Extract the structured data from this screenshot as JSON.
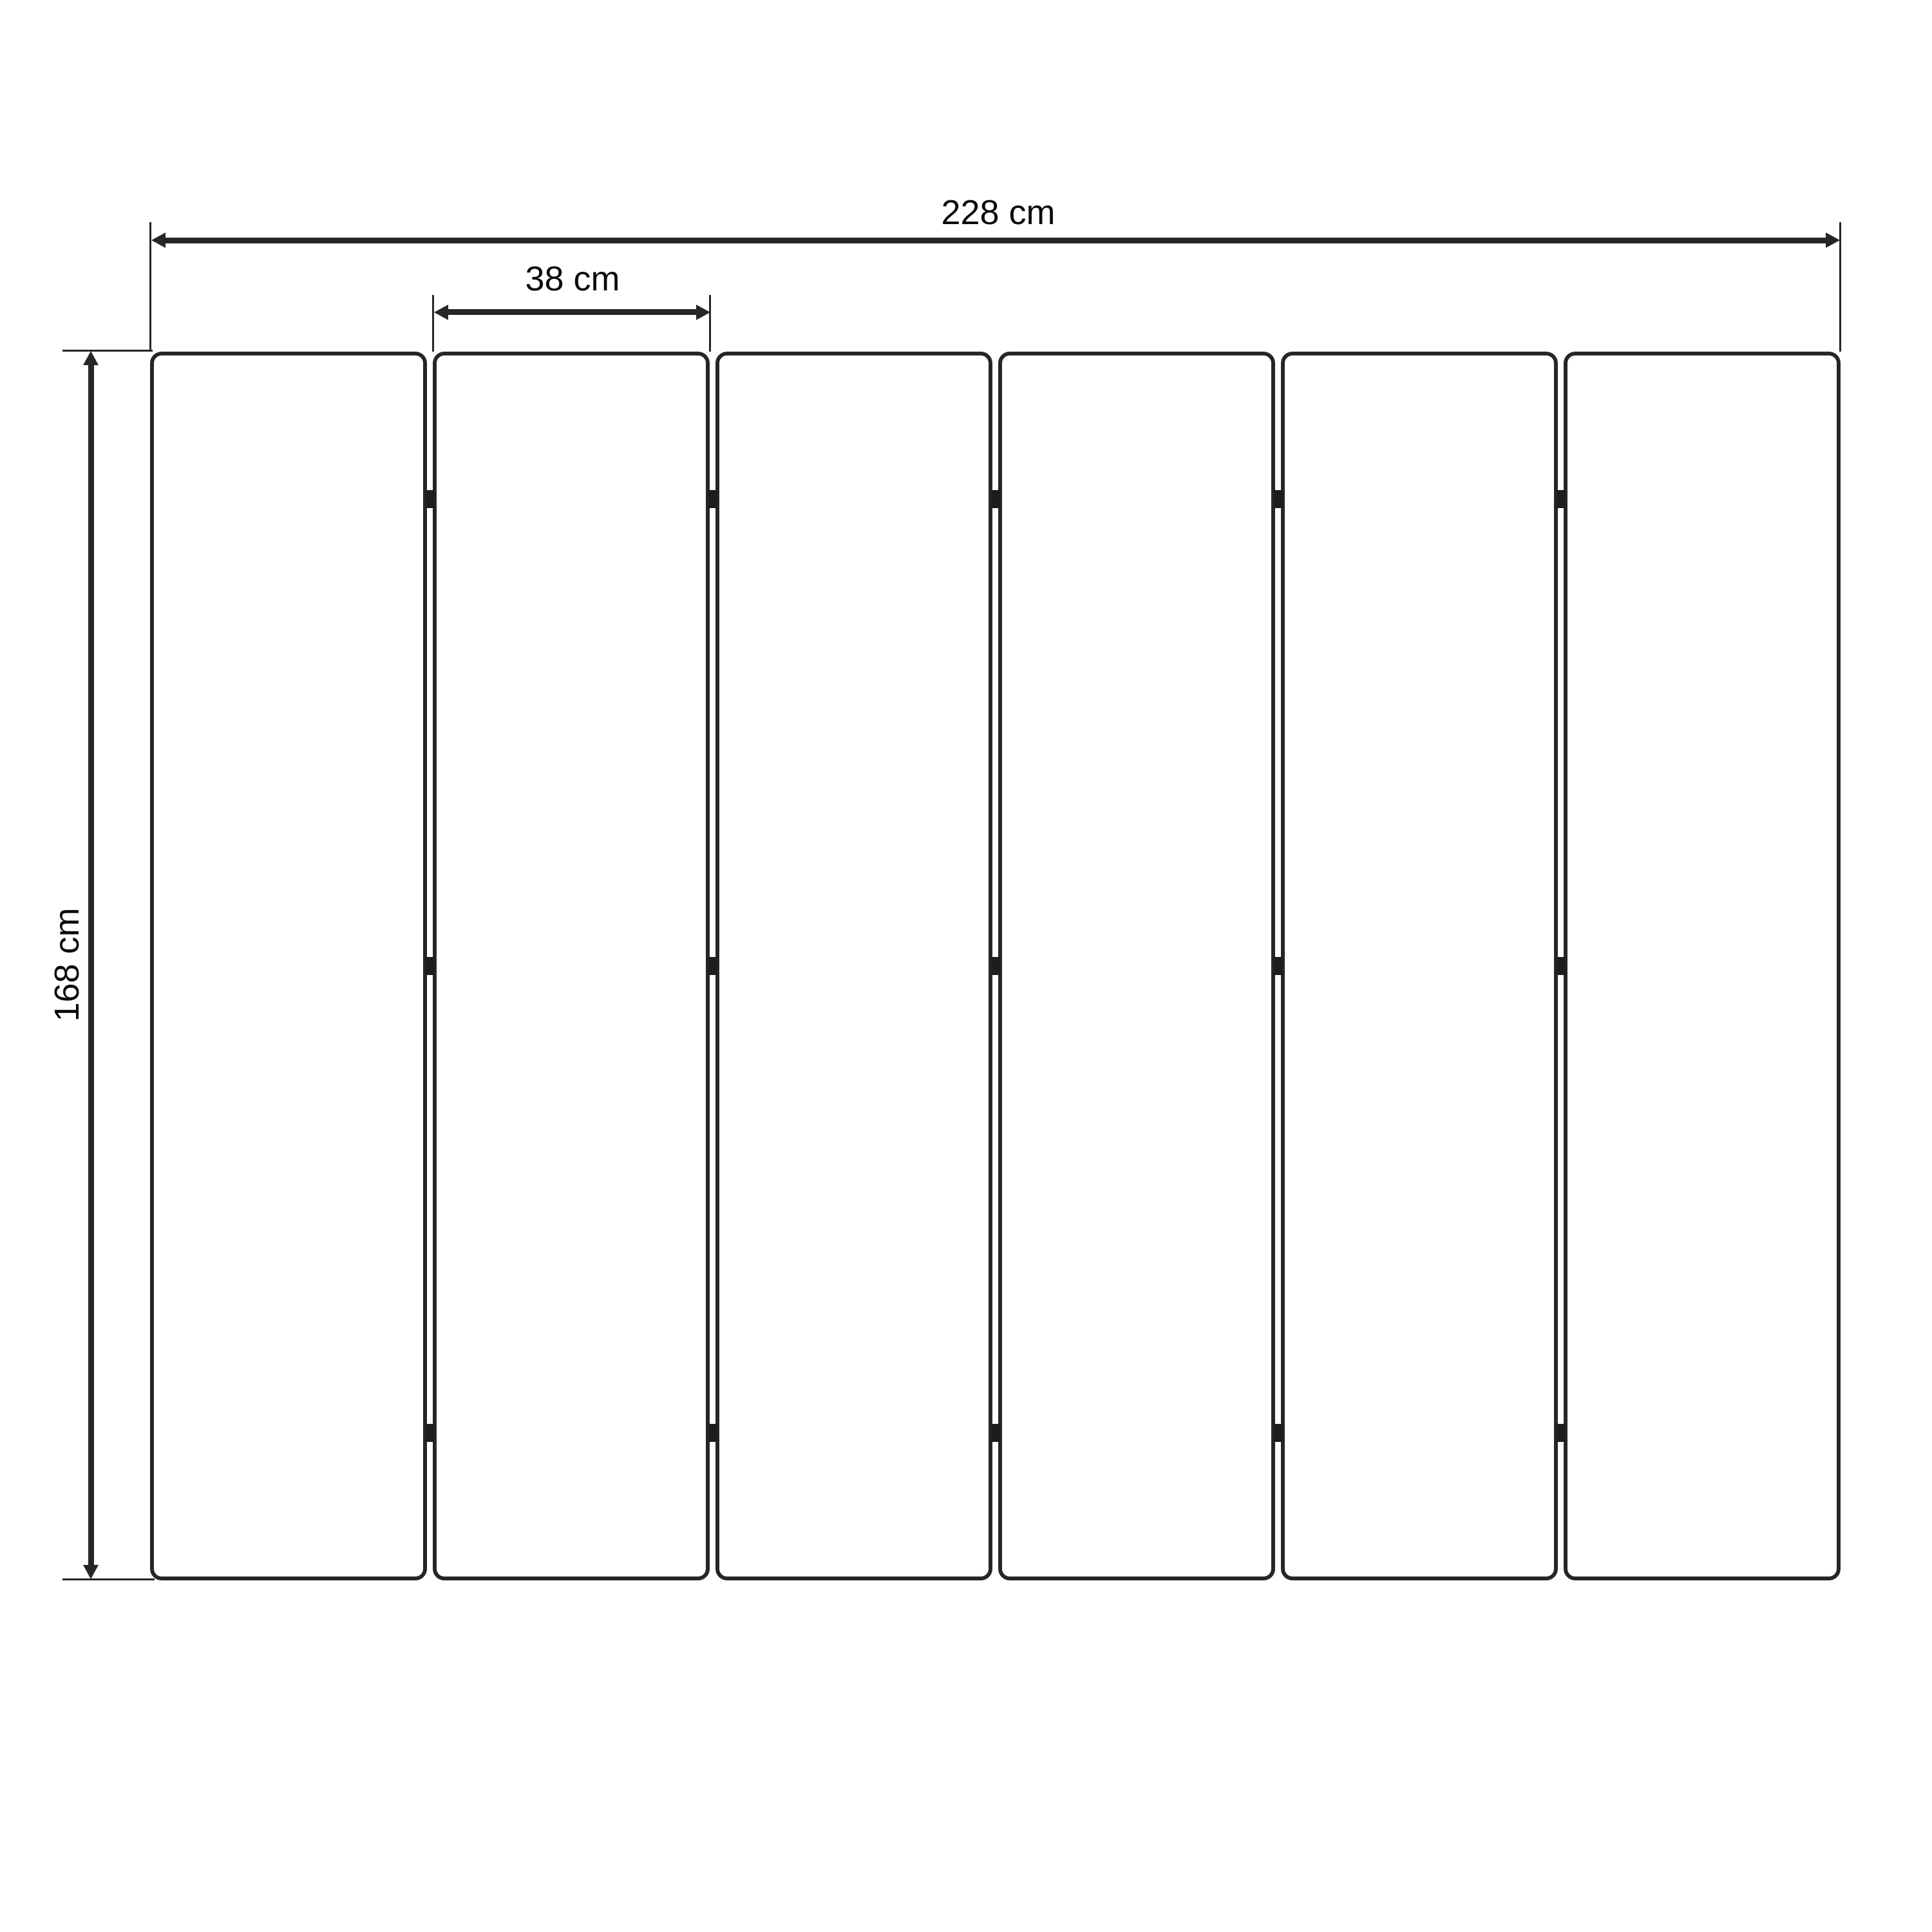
{
  "diagram": {
    "panel_count": 6,
    "hinge_rows_per_gap": 3,
    "dimensions": {
      "total_width": {
        "label": "228 cm",
        "value": 228,
        "unit": "cm"
      },
      "panel_width": {
        "label": "38 cm",
        "value": 38,
        "unit": "cm"
      },
      "height": {
        "label": "168 cm",
        "value": 168,
        "unit": "cm"
      }
    },
    "colors": {
      "line": "#262626",
      "hinge": "#1d1d1d",
      "label_text": "#0b0b0b",
      "background": "#ffffff"
    }
  }
}
